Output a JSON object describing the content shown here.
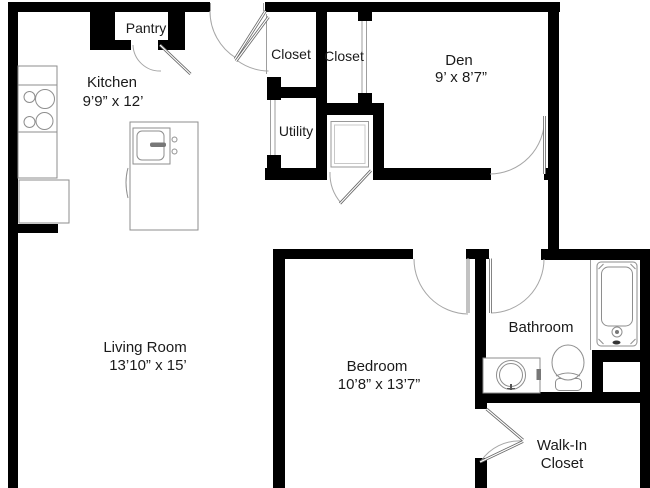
{
  "plan": {
    "title": "Apartment floor plan",
    "rooms": {
      "pantry": {
        "name": "Pantry"
      },
      "kitchen": {
        "name": "Kitchen",
        "dims": "9’9” x 12’"
      },
      "entry_closet": {
        "name": "Closet"
      },
      "den_closet": {
        "name": "Closet"
      },
      "den": {
        "name": "Den",
        "dims": "9’ x 8’7”"
      },
      "utility": {
        "name": "Utility"
      },
      "living_room": {
        "name": "Living Room",
        "dims": "13’10” x 15’"
      },
      "bedroom": {
        "name": "Bedroom",
        "dims": "10’8” x 13’7”"
      },
      "bathroom": {
        "name": "Bathroom"
      },
      "walk_in_closet": {
        "name": "Walk-In\nCloset"
      }
    },
    "fixtures": [
      "stove",
      "counter",
      "refrigerator",
      "island-sink",
      "dishwasher",
      "washer-dryer",
      "bathtub",
      "toilet",
      "vanity-sink"
    ],
    "colors": {
      "wall": "#000000",
      "fixture_line": "#8e8e8e",
      "door_line": "#9e9e9e",
      "text": "#1a1a1a",
      "background": "#ffffff"
    }
  }
}
